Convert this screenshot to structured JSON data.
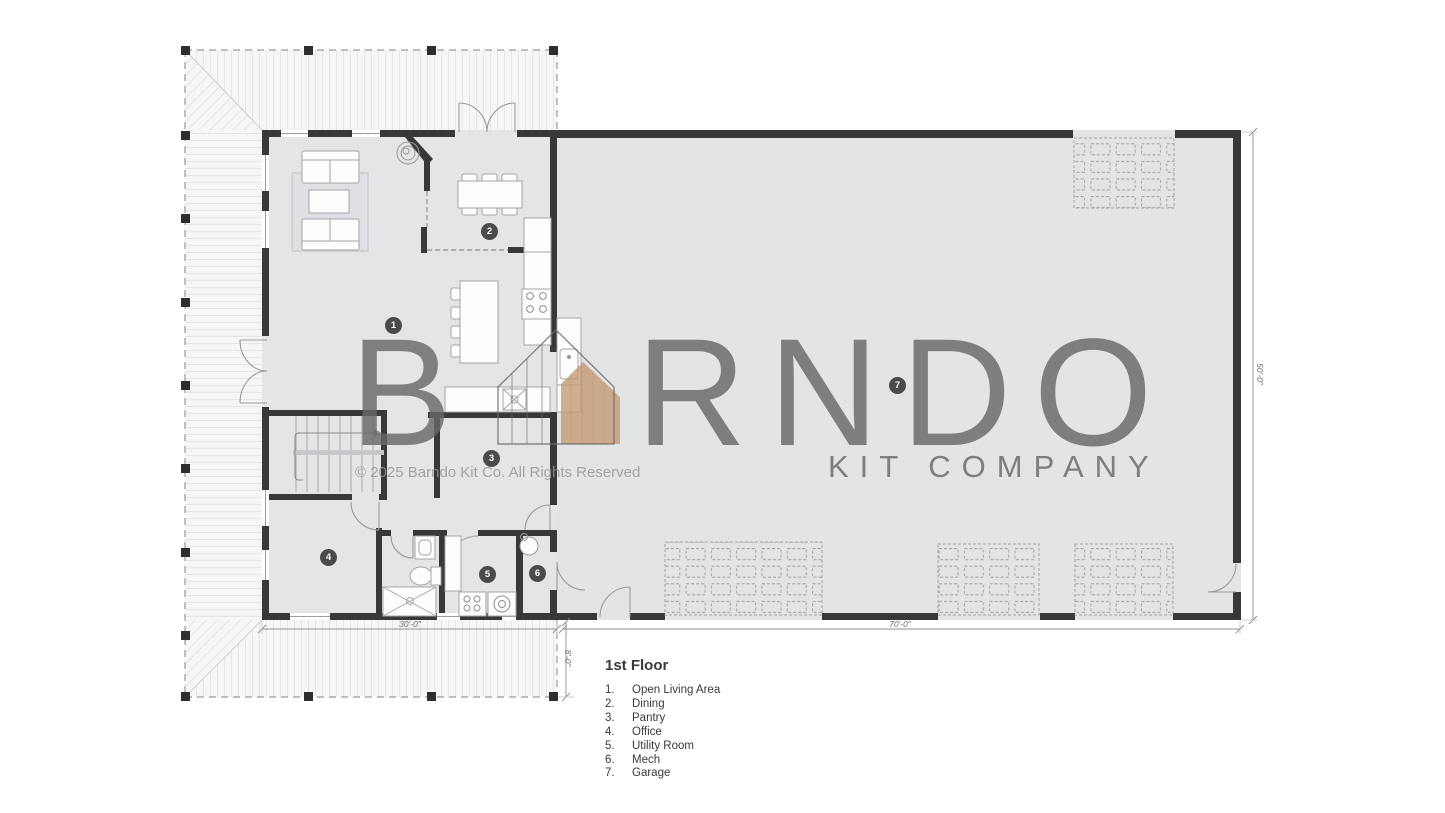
{
  "watermark": {
    "brand_prefix": "B",
    "brand_suffix": "RNDO",
    "subtitle": "KIT COMPANY",
    "copyright": "© 2025 Barndo Kit Co. All Rights Reserved"
  },
  "legend": {
    "title": "1st Floor",
    "items": [
      {
        "num": "1.",
        "label": "Open Living Area"
      },
      {
        "num": "2.",
        "label": "Dining"
      },
      {
        "num": "3.",
        "label": "Pantry"
      },
      {
        "num": "4.",
        "label": "Office"
      },
      {
        "num": "5.",
        "label": "Utility Room"
      },
      {
        "num": "6.",
        "label": "Mech"
      },
      {
        "num": "7.",
        "label": "Garage"
      }
    ]
  },
  "dimensions": {
    "living_width": "30'-0\"",
    "garage_width": "70'-0\"",
    "building_depth": "50'-0\"",
    "porch_depth": "8'-0\""
  },
  "room_badges": [
    {
      "number": "1",
      "room": "Open Living Area"
    },
    {
      "number": "2",
      "room": "Dining"
    },
    {
      "number": "3",
      "room": "Pantry"
    },
    {
      "number": "4",
      "room": "Office"
    },
    {
      "number": "5",
      "room": "Utility Room"
    },
    {
      "number": "6",
      "room": "Mech"
    },
    {
      "number": "7",
      "room": "Garage"
    }
  ],
  "colors": {
    "wall": "#383838",
    "floor": "#e4e5e7",
    "porch": "#f6f6f7",
    "badge": "#4b4b4b",
    "watermark": "#6e6e6e",
    "barn_accent": "#c9a183"
  }
}
